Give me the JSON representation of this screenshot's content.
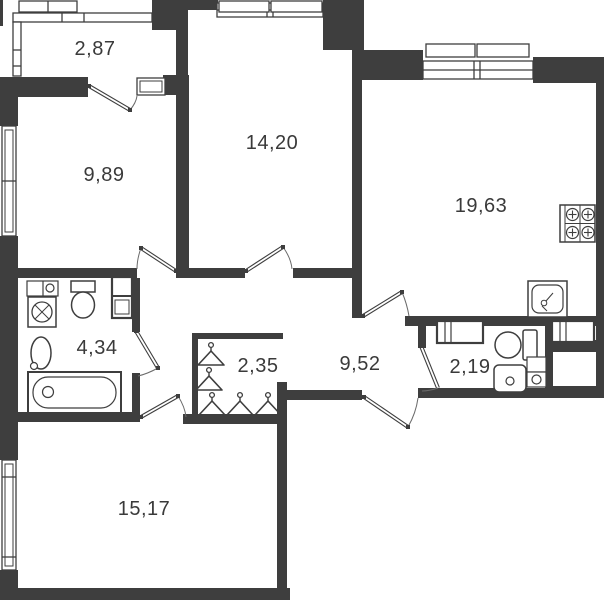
{
  "plan": {
    "wall_color": "#3e3e3e",
    "line_color": "#4a4a4a",
    "background_color": "#ffffff",
    "label_color": "#3a3a3a",
    "rooms": {
      "balcony": {
        "area": "2,87"
      },
      "room_left": {
        "area": "9,89"
      },
      "room_top": {
        "area": "14,20"
      },
      "kitchen_living": {
        "area": "19,63"
      },
      "bathroom": {
        "area": "4,34"
      },
      "wardrobe": {
        "area": "2,35"
      },
      "hallway": {
        "area": "9,52"
      },
      "wc": {
        "area": "2,19"
      },
      "room_bottom": {
        "area": "15,17"
      }
    }
  }
}
